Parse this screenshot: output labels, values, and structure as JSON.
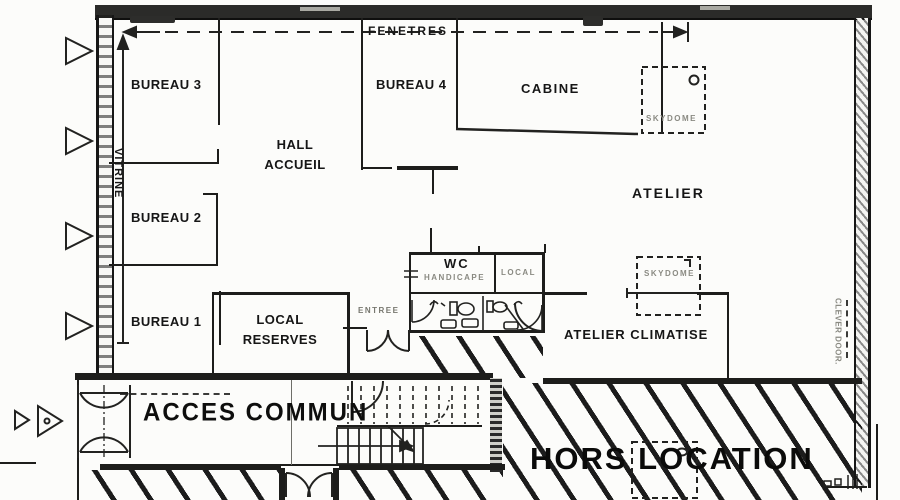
{
  "plan": {
    "colors": {
      "ink": "#1d1d1b",
      "faint_text": "#8a8a82",
      "paper": "#fcfcfa"
    },
    "outside": {
      "windows_label": "FENETRES",
      "shopfront_label": "VITRINE"
    },
    "rooms": {
      "bureau_3": "BUREAU 3",
      "bureau_4": "BUREAU 4",
      "cabine": "CABINE",
      "hall_line1": "HALL",
      "hall_line2": "ACCUEIL",
      "atelier": "ATELIER",
      "bureau_2": "BUREAU 2",
      "bureau_1": "BUREAU 1",
      "reserves_line1": "LOCAL",
      "reserves_line2": "RESERVES",
      "atelier_climatise": "ATELIER CLIMATISE"
    },
    "sanitary": {
      "wc": "WC",
      "handicape": "HANDICAPE",
      "local": "LOCAL"
    },
    "features": {
      "skydome": "SKYDOME",
      "clever_door": "CLEVER DOOR.",
      "entree": "ENTREE"
    },
    "zones": {
      "acces_commun": "ACCES COMMUN",
      "hors_location": "HORS LOCATION"
    }
  }
}
